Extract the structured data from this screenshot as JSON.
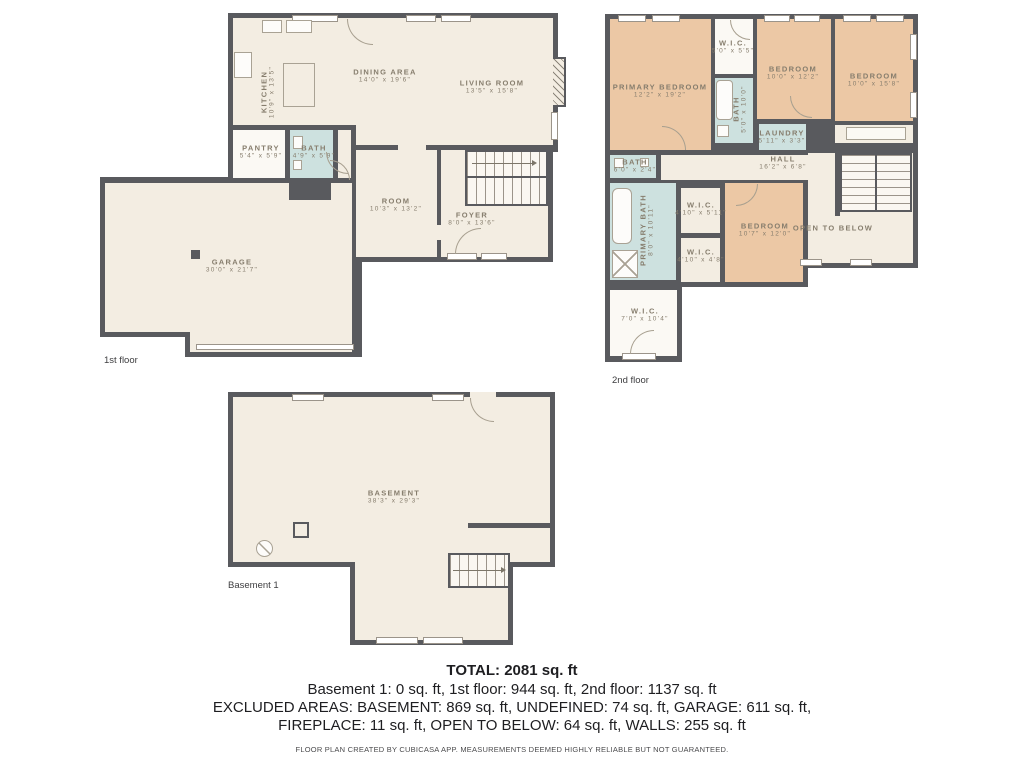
{
  "palette": {
    "wall": "#595a5e",
    "floor": "#f3ede2",
    "bedroom_fill": "#ecc8a5",
    "wet_room_fill": "#cde1df",
    "closet_fill": "#fbf9f4",
    "room_label_text": "#867d6d",
    "summary_text": "#1e1e21"
  },
  "floors": {
    "first": {
      "label": "1st floor",
      "rooms": [
        {
          "name": "KITCHEN",
          "dims": "10'9\" x 13'5\""
        },
        {
          "name": "DINING AREA",
          "dims": "14'0\" x 19'6\""
        },
        {
          "name": "LIVING ROOM",
          "dims": "13'5\" x 15'8\""
        },
        {
          "name": "PANTRY",
          "dims": "5'4\" x 5'9\""
        },
        {
          "name": "BATH",
          "dims": "4'9\" x 5'9\""
        },
        {
          "name": "ROOM",
          "dims": "10'3\" x 13'2\""
        },
        {
          "name": "FOYER",
          "dims": "8'0\" x 13'6\""
        },
        {
          "name": "GARAGE",
          "dims": "30'0\" x 21'7\""
        }
      ]
    },
    "second": {
      "label": "2nd floor",
      "rooms": [
        {
          "name": "PRIMARY BEDROOM",
          "dims": "12'2\" x 19'2\""
        },
        {
          "name": "W.I.C.",
          "dims": "5'0\" x 5'5\""
        },
        {
          "name": "BATH",
          "dims": "5'0\" x 10'0\""
        },
        {
          "name": "BEDROOM",
          "dims": "10'0\" x 12'2\""
        },
        {
          "name": "BEDROOM",
          "dims": "10'0\" x 15'8\""
        },
        {
          "name": "LAUNDRY",
          "dims": "5'11\" x 3'3\""
        },
        {
          "name": "HALL",
          "dims": "16'2\" x 6'8\""
        },
        {
          "name": "BATH",
          "dims": "6'0\" x 2'4\""
        },
        {
          "name": "PRIMARY BATH",
          "dims": "8'0\" x 10'11\""
        },
        {
          "name": "W.I.C.",
          "dims": "4'10\" x 5'11\""
        },
        {
          "name": "W.I.C.",
          "dims": "4'10\" x 4'8\""
        },
        {
          "name": "BEDROOM",
          "dims": "10'7\" x 12'0\""
        },
        {
          "name": "OPEN TO BELOW",
          "dims": ""
        },
        {
          "name": "W.I.C.",
          "dims": "7'0\" x 10'4\""
        }
      ]
    },
    "basement": {
      "label": "Basement 1",
      "rooms": [
        {
          "name": "BASEMENT",
          "dims": "38'3\" x 29'3\""
        }
      ]
    }
  },
  "summary": {
    "total": "TOTAL: 2081 sq. ft",
    "floors_line": "Basement 1: 0 sq. ft, 1st floor: 944 sq. ft, 2nd floor: 1137 sq. ft",
    "excluded_line1": "EXCLUDED AREAS: BASEMENT: 869 sq. ft, UNDEFINED: 74 sq. ft, GARAGE: 611 sq. ft,",
    "excluded_line2": "FIREPLACE: 11 sq. ft, OPEN TO BELOW: 64 sq. ft, WALLS: 255 sq. ft",
    "disclaimer": "FLOOR PLAN CREATED BY CUBICASA APP. MEASUREMENTS DEEMED HIGHLY RELIABLE BUT NOT GUARANTEED."
  }
}
